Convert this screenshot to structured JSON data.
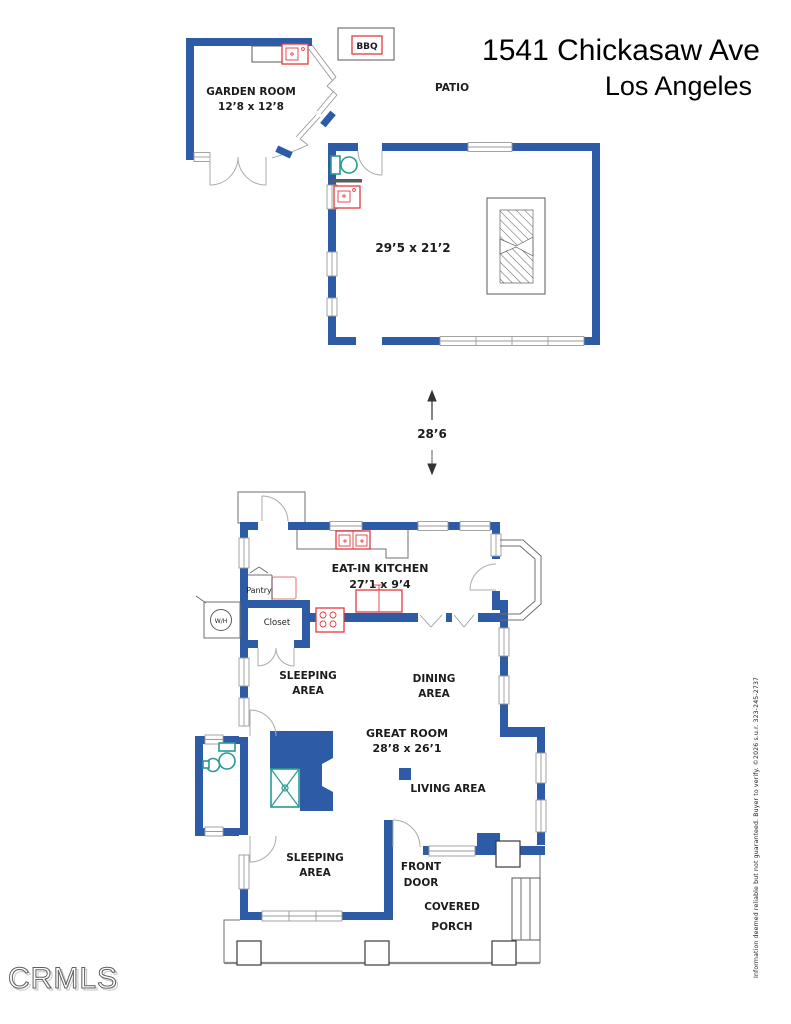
{
  "colors": {
    "wall": "#2d5ba6",
    "fixture_red": "#e6393f",
    "fixture_teal": "#2a9a92",
    "fixture_pink": "#efa3a6",
    "line_gray": "#6f6f6f",
    "text": "#1c1c1c"
  },
  "header": {
    "title": "1541 Chickasaw Ave",
    "city": "Los Angeles"
  },
  "site": {
    "garden_room": {
      "name": "GARDEN ROOM",
      "dims": "12’8 x 12’8"
    },
    "bbq": "BBQ",
    "patio": "PATIO",
    "rec_room": {
      "dims": "29’5 x 21’2"
    },
    "separation": {
      "dims": "28’6"
    }
  },
  "house": {
    "kitchen": {
      "name": "EAT-IN KITCHEN",
      "dims": "27’1 x 9’4"
    },
    "pantry": "Pantry",
    "closet": "Closet",
    "water_heater": "W/H",
    "sleeping_upper": {
      "line1": "SLEEPING",
      "line2": "AREA"
    },
    "dining": {
      "line1": "DINING",
      "line2": "AREA"
    },
    "great_room": {
      "name": "GREAT ROOM",
      "dims": "28’8 x 26’1"
    },
    "living": "LIVING AREA",
    "sleeping_lower": {
      "line1": "SLEEPING",
      "line2": "AREA"
    },
    "front_door": {
      "line1": "FRONT",
      "line2": "DOOR"
    },
    "covered_porch": {
      "line1": "COVERED",
      "line2": "PORCH"
    }
  },
  "footer": {
    "logo": "CRMLS",
    "disclaimer": "Information deemed reliable but not guaranteed. Buyer to verify. ©2026 s.u.r. 323-245-2737"
  }
}
